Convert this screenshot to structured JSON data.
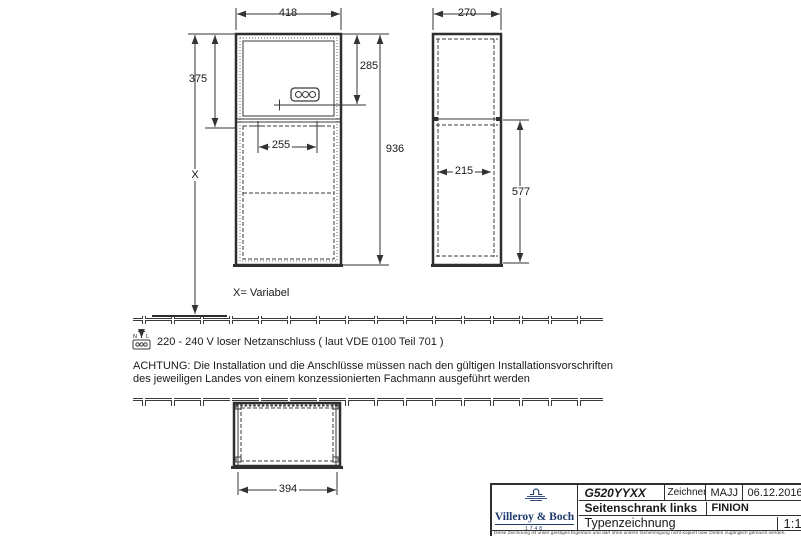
{
  "front_view": {
    "width_label": "418",
    "upper_height_label": "375",
    "socket_height_label": "285",
    "inner_width_label": "255",
    "total_height_label": "936",
    "variable_height_label": "X"
  },
  "side_view": {
    "depth_label": "270",
    "inner_depth_label": "215",
    "lower_height_label": "577"
  },
  "bottom_view": {
    "width_label": "394"
  },
  "notes": {
    "variable": "X= Variabel",
    "power": "220 - 240 V loser Netzanschluss ( laut VDE 0100 Teil 701 )",
    "warning_line1": "ACHTUNG: Die Installation und die Anschlüsse müssen nach den gültigen Installationsvorschriften",
    "warning_line2": "des jeweiligen Landes von einem konzessionierten Fachmann ausgeführt werden"
  },
  "icons": {
    "power": {
      "n": "N",
      "l": "L"
    }
  },
  "title_block": {
    "article": "G520YYXX",
    "zeichner_label": "Zeichner",
    "zeichner": "MAJJ",
    "date": "06.12.2016",
    "description": "Seitenschrank links",
    "series": "FINION",
    "type": "Typenzeichnung",
    "scale": "1:12",
    "brand": "Villeroy & Boch",
    "brand_year": "1748",
    "brand_color": "#1f3a6d",
    "disclaimer": "Diese Zeichnung ist unser geistiges Eigentum und darf ohne unsere Genehmigung nicht kopiert oder Dritten zugänglich gemacht werden."
  }
}
